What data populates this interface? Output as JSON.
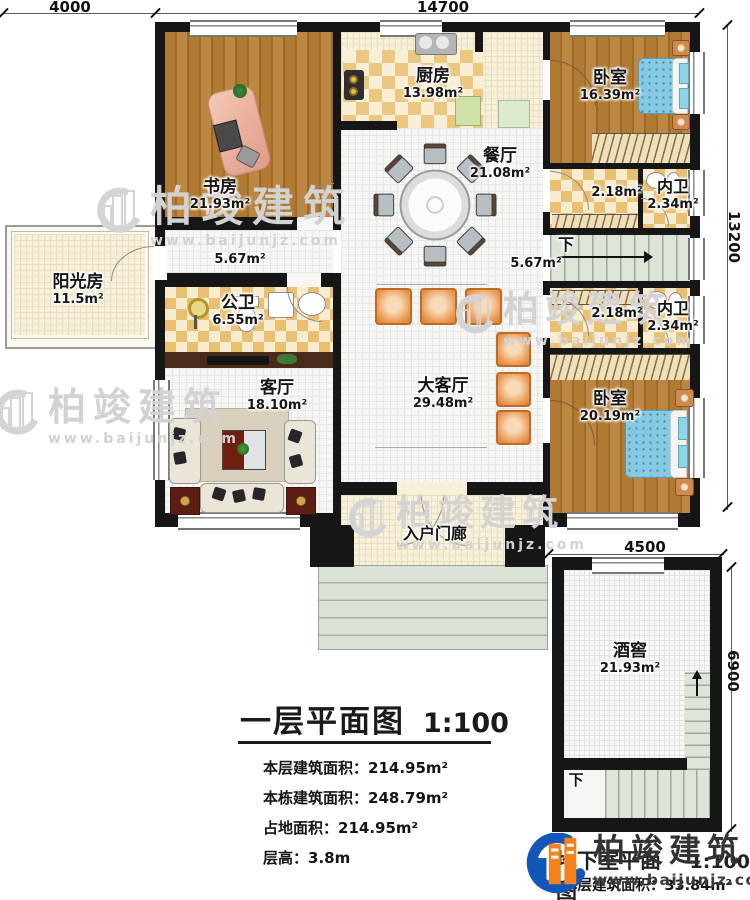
{
  "watermark": {
    "brand": "柏竣建筑",
    "url": "www.baijunjz.com"
  },
  "logo": {
    "brand": "柏竣建筑",
    "url": "www.baijunjz.com"
  },
  "dimensions": {
    "top_left": "4000",
    "top_main": "14700",
    "right_main": "13200",
    "basement_width": "4500",
    "basement_height": "6900"
  },
  "rooms": {
    "study": {
      "name": "书房",
      "area": "21.93m²"
    },
    "kitchen": {
      "name": "厨房",
      "area": "13.98m²"
    },
    "dining": {
      "name": "餐厅",
      "area": "21.08m²"
    },
    "bedroom1": {
      "name": "卧室",
      "area": "16.39m²"
    },
    "closet1": {
      "area": "2.18m²"
    },
    "bath1": {
      "name": "内卫",
      "area": "2.34m²"
    },
    "hall_left": {
      "area": "5.67m²"
    },
    "hall_right": {
      "area": "5.67m²"
    },
    "stair_main": {
      "label": "下"
    },
    "sunroom": {
      "name": "阳光房",
      "area": "11.5m²"
    },
    "pubbath": {
      "name": "公卫",
      "area": "6.55m²"
    },
    "living": {
      "name": "客厅",
      "area": "18.10m²"
    },
    "greathall": {
      "name": "大客厅",
      "area": "29.48m²"
    },
    "closet2": {
      "area": "2.18m²"
    },
    "bath2": {
      "name": "内卫",
      "area": "2.34m²"
    },
    "bedroom2": {
      "name": "卧室",
      "area": "20.19m²"
    },
    "porch": {
      "name": "入户门廊"
    },
    "cellar": {
      "name": "酒窖",
      "area": "21.93m²"
    },
    "stair_basement": {
      "label": "下"
    }
  },
  "title_block": {
    "title": "一层平面图",
    "scale": "1:100",
    "stats": [
      {
        "label": "本层建筑面积：",
        "value": "214.95m²"
      },
      {
        "label": "本栋建筑面积：",
        "value": "248.79m²"
      },
      {
        "label": "占地面积：",
        "value": "214.95m²"
      },
      {
        "label": "层高：",
        "value": "3.8m"
      }
    ]
  },
  "basement_block": {
    "title": "地下室平面图",
    "scale": "1:100",
    "stat_label": "本层建筑面积：",
    "stat_value": "33.84m²"
  }
}
